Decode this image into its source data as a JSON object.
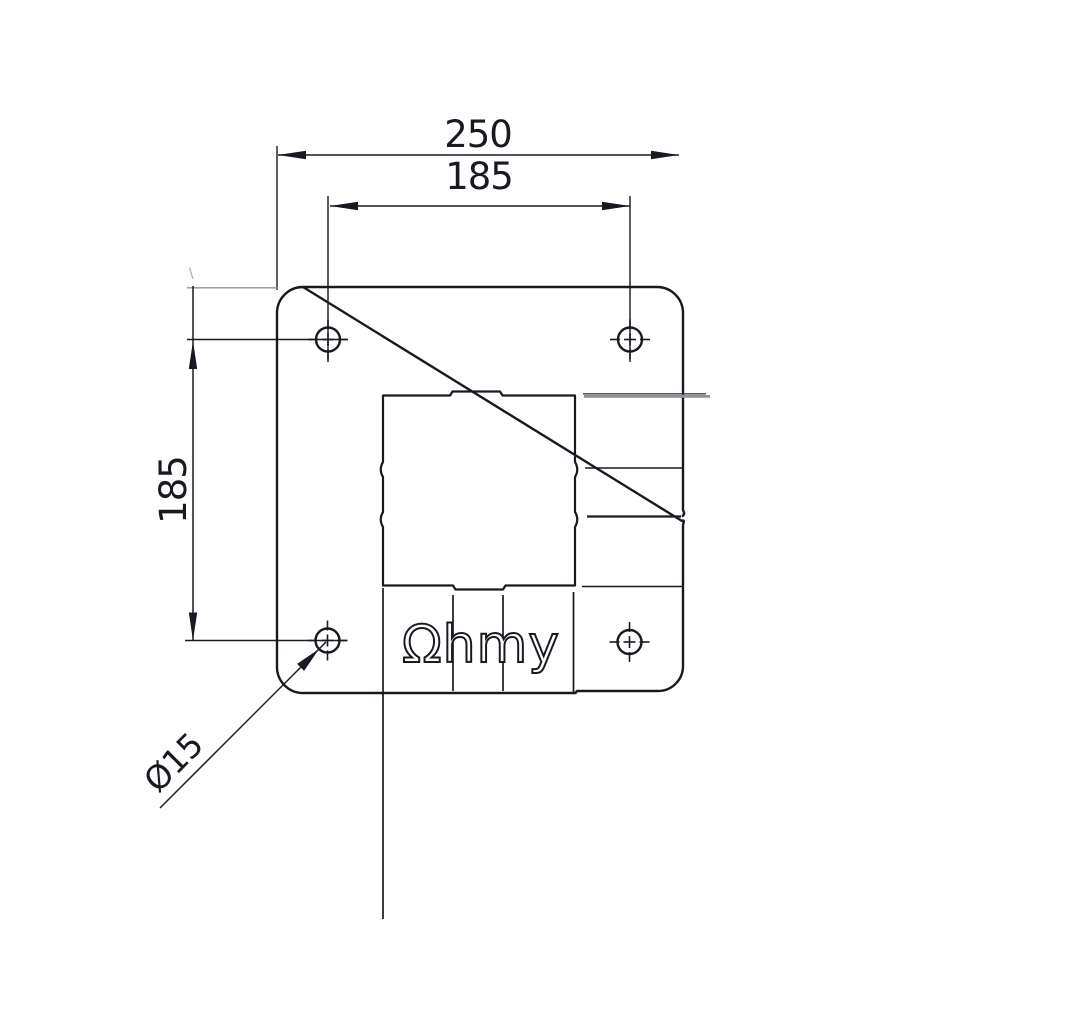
{
  "drawing": {
    "type": "technical-dimension-drawing",
    "part": "square mounting plate, top view",
    "dimensions": {
      "overall_width": "250",
      "hole_pitch_horizontal": "185",
      "hole_pitch_vertical": "185",
      "hole_diameter": "Ø15"
    },
    "logo_text": "Ωhmy",
    "features": {
      "mounting_holes": 4,
      "center_cutout": "square knockout with relief tabs",
      "slot_lines": 4
    }
  },
  "colors": {
    "ink": "#181921",
    "muted_gray": "#8f9097",
    "artifact_gray": "#b2b3ba",
    "background": "#ffffff"
  }
}
